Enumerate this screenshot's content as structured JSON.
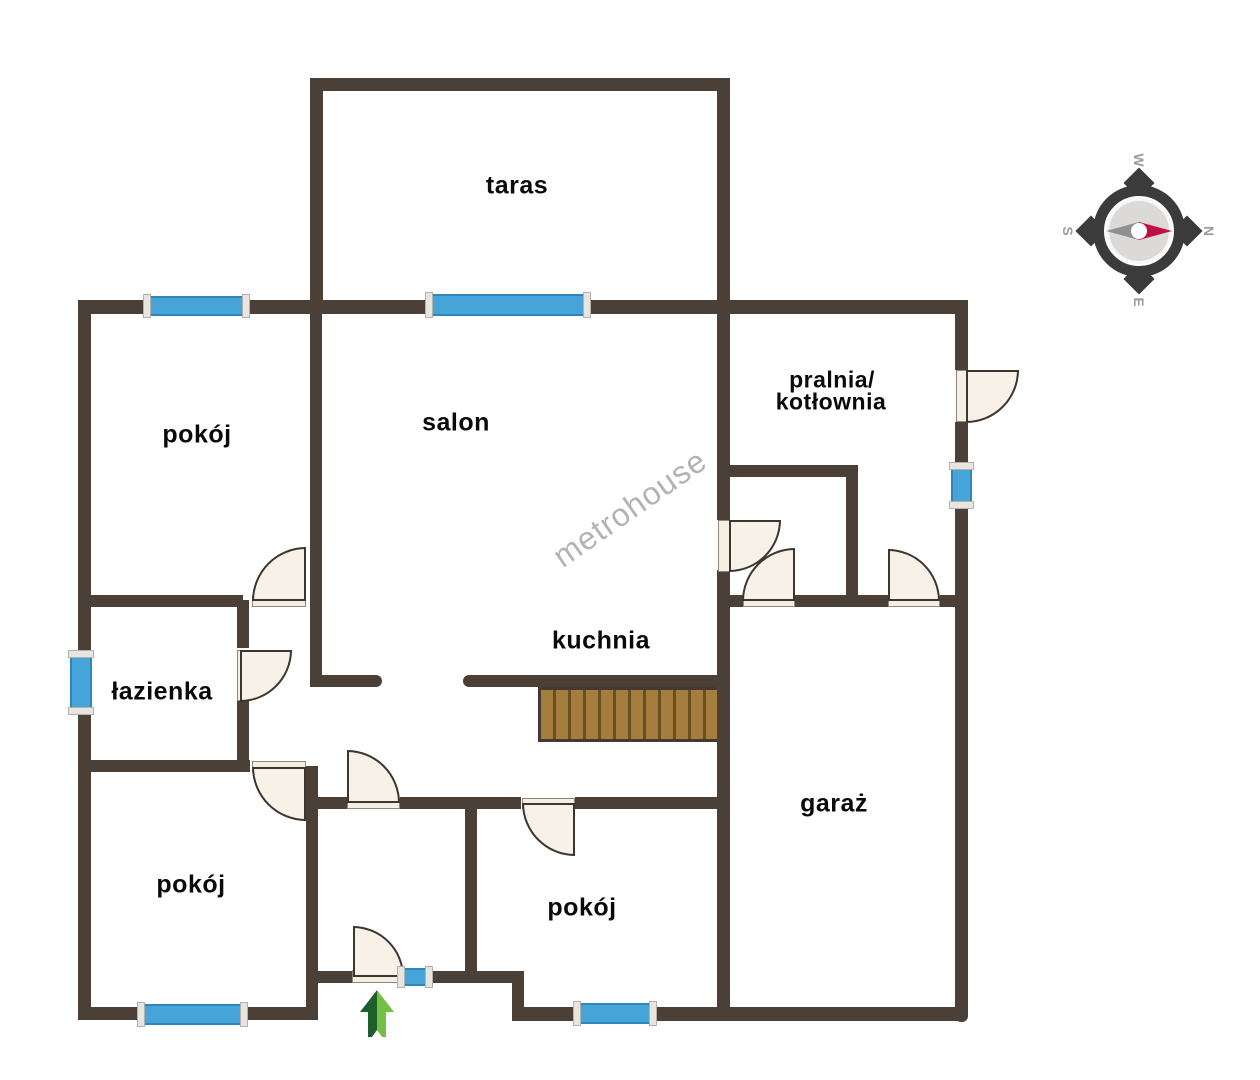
{
  "watermark": {
    "text": "metrohouse",
    "color": "#b4b2b2"
  },
  "rooms": {
    "taras": {
      "label": "taras"
    },
    "pokoj_top_left": {
      "label": "pokój"
    },
    "salon": {
      "label": "salon"
    },
    "pralnia": {
      "label_line1": "pralnia/",
      "label_line2": "kotłownia"
    },
    "lazienka": {
      "label": "łazienka"
    },
    "kuchnia": {
      "label": "kuchnia"
    },
    "garaz": {
      "label": "garaż"
    },
    "pokoj_bottom_left": {
      "label": "pokój"
    },
    "pokoj_bottom_middle": {
      "label": "pokój"
    }
  },
  "compass": {
    "north": "N",
    "east": "E",
    "south": "S",
    "west": "W",
    "needle_color": "#bf1043",
    "tail_color": "#8f8f8f",
    "ring_color": "#3b3b3b",
    "letter_color": "#9c9c9c"
  },
  "colors": {
    "wall": "#4b4037",
    "window_fill": "#47a4d9",
    "window_cap": "#e8e5e0",
    "door_fill": "#f8f1e7",
    "door_stroke": "#3d352e",
    "stairs_fill": "#a47d3f",
    "stairs_divider": "#69511f",
    "entrance_arrow_dark": "#1d5e2a",
    "entrance_arrow_light": "#74c044",
    "label_color": "#0a0a0a"
  }
}
